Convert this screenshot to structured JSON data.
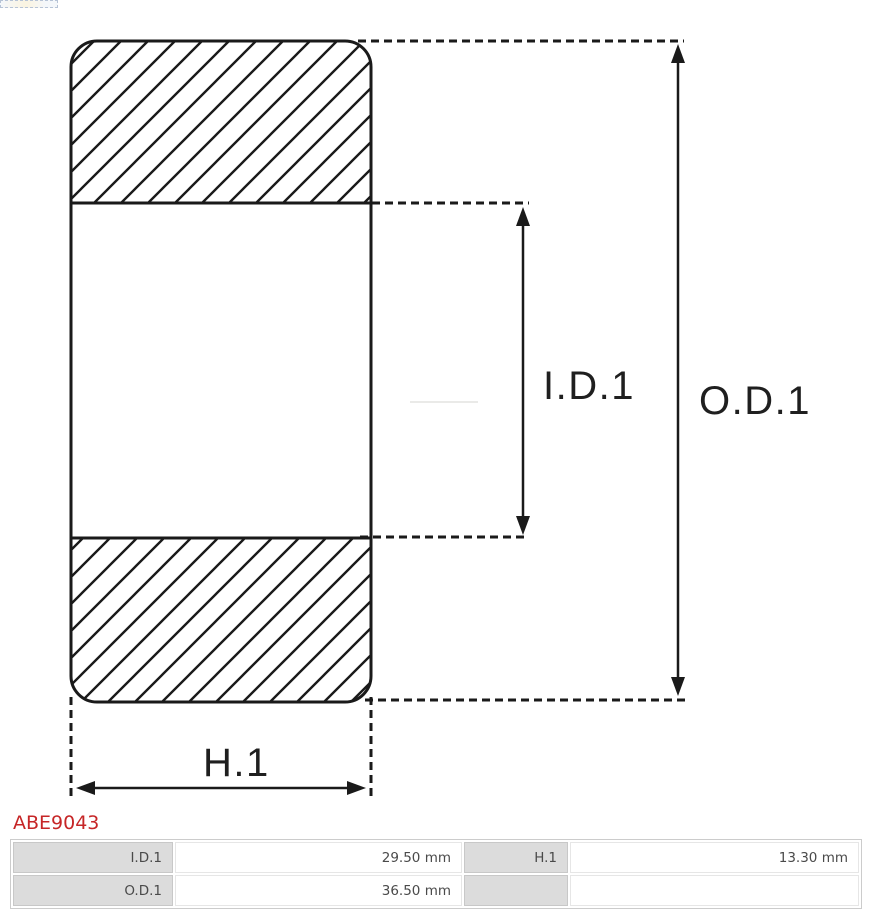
{
  "part_number": "ABE9043",
  "diagram": {
    "inner_diameter_label": "I.D.1",
    "outer_diameter_label": "O.D.1",
    "height_label": "H.1"
  },
  "spec_table": {
    "rows": [
      {
        "c0_label": "I.D.1",
        "c1_value": "29.50 mm",
        "c2_label": "H.1",
        "c3_value": "13.30 mm"
      },
      {
        "c0_label": "O.D.1",
        "c1_value": "36.50 mm",
        "c2_label": "",
        "c3_value": ""
      }
    ]
  },
  "colors": {
    "accent_red": "#c62627",
    "line_black": "#1a1a1a",
    "cell_gray": "#dcdcdc"
  }
}
